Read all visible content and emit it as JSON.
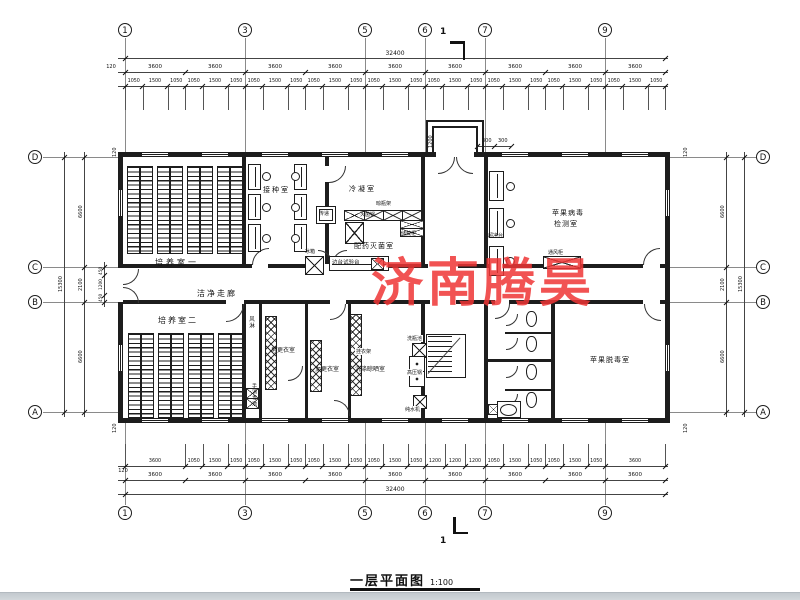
{
  "watermark": {
    "text": "济南腾昊",
    "color": "#ee3535"
  },
  "titleblock": {
    "title": "一层平面图",
    "scale": "1:100"
  },
  "section_marker": {
    "label": "1"
  },
  "axes": {
    "horizontal": [
      {
        "label": "1",
        "mm": 0
      },
      {
        "label": "3",
        "mm": 7200
      },
      {
        "label": "5",
        "mm": 14400
      },
      {
        "label": "6",
        "mm": 18000
      },
      {
        "label": "7",
        "mm": 21600
      },
      {
        "label": "9",
        "mm": 28800
      }
    ],
    "vertical": [
      {
        "label": "D",
        "mm": 0
      },
      {
        "label": "C",
        "mm": 6600
      },
      {
        "label": "B",
        "mm": 8700
      },
      {
        "label": "A",
        "mm": 15300
      }
    ],
    "total_width_mm": 32400,
    "total_height_mm": 15300
  },
  "dims": {
    "top_overall": [
      32400
    ],
    "top_bays": [
      3600,
      3600,
      3600,
      3600,
      3600,
      3600,
      3600,
      3600,
      3600
    ],
    "top_detail": [
      1050,
      1500,
      1050,
      1050,
      1500,
      1050,
      1050,
      1500,
      1050,
      1050,
      1500,
      1050,
      1050,
      1500,
      1050,
      1050,
      1500,
      1050,
      1050,
      1500,
      1050,
      1050,
      1500,
      1050,
      1050,
      1500,
      1050
    ],
    "bottom_detail": [
      3600,
      1050,
      1500,
      1050,
      1050,
      1500,
      1050,
      1050,
      1500,
      1050,
      1050,
      1500,
      1050,
      1200,
      1200,
      1200,
      1050,
      1500,
      1050,
      1050,
      1500,
      1050,
      3600
    ],
    "bottom_bays": [
      3600,
      3600,
      3600,
      3600,
      3600,
      3600,
      3600,
      3600,
      3600
    ],
    "bottom_overall": [
      32400
    ],
    "left_segs": [
      6600,
      2100,
      6600
    ],
    "left_overall": [
      15300
    ],
    "left_subs": [
      450,
      1200,
      450
    ],
    "right_segs": [
      6600,
      2100,
      6600
    ],
    "right_overall": [
      15300
    ],
    "offset_labels": [
      {
        "t": "120",
        "x": 103,
        "y": 64,
        "r": false
      },
      {
        "t": "120",
        "x": 115,
        "y": 468,
        "r": false
      },
      {
        "t": "120",
        "x": 112,
        "y": 158,
        "r": true
      },
      {
        "t": "120",
        "x": 112,
        "y": 434,
        "r": true
      },
      {
        "t": "120",
        "x": 683,
        "y": 158,
        "r": true
      },
      {
        "t": "120",
        "x": 683,
        "y": 434,
        "r": true
      }
    ],
    "porch": {
      "depth": "1200",
      "w1": "300",
      "w2": "300"
    }
  },
  "plan": {
    "walls": [
      [
        118,
        152,
        552,
        5
      ],
      [
        118,
        418,
        552,
        5
      ],
      [
        118,
        152,
        5,
        271
      ],
      [
        665,
        152,
        5,
        271
      ],
      [
        123,
        264,
        542,
        4
      ],
      [
        123,
        300,
        542,
        4
      ],
      [
        242,
        157,
        4,
        107
      ],
      [
        325,
        157,
        4,
        107
      ],
      [
        421,
        157,
        4,
        107
      ],
      [
        484,
        157,
        4,
        107
      ],
      [
        242,
        304,
        4,
        114
      ],
      [
        259,
        304,
        3,
        114
      ],
      [
        305,
        304,
        3,
        114
      ],
      [
        348,
        304,
        3,
        114
      ],
      [
        421,
        304,
        4,
        114
      ],
      [
        484,
        304,
        4,
        114
      ],
      [
        551,
        304,
        4,
        114
      ],
      [
        488,
        359,
        63,
        3
      ],
      [
        505,
        332,
        46,
        2
      ],
      [
        505,
        389,
        46,
        2
      ],
      [
        426,
        120,
        2,
        34
      ],
      [
        426,
        120,
        58,
        2
      ],
      [
        482,
        120,
        2,
        34
      ],
      [
        432,
        126,
        2,
        28
      ],
      [
        432,
        126,
        46,
        2
      ],
      [
        476,
        126,
        2,
        28
      ]
    ],
    "door_gaps": [
      [
        436,
        152,
        38,
        5
      ],
      [
        118,
        268,
        5,
        34
      ],
      [
        318,
        264,
        28,
        4
      ],
      [
        252,
        264,
        16,
        4
      ],
      [
        643,
        264,
        17,
        4
      ],
      [
        428,
        264,
        30,
        4
      ],
      [
        226,
        300,
        18,
        4
      ],
      [
        330,
        300,
        16,
        4
      ],
      [
        430,
        300,
        26,
        4
      ],
      [
        495,
        300,
        14,
        4
      ],
      [
        643,
        300,
        17,
        4
      ],
      [
        325,
        166,
        4,
        16
      ]
    ],
    "door_arcs": [
      [
        438,
        157,
        16,
        "br"
      ],
      [
        456,
        157,
        16,
        "bl"
      ],
      [
        123,
        269,
        15,
        "br"
      ],
      [
        123,
        287,
        15,
        "tr"
      ],
      [
        318,
        250,
        14,
        "tr"
      ],
      [
        332,
        250,
        14,
        "tl"
      ],
      [
        226,
        304,
        17,
        "br"
      ],
      [
        252,
        248,
        16,
        "tl"
      ],
      [
        329,
        166,
        16,
        "br"
      ],
      [
        643,
        248,
        16,
        "tl"
      ],
      [
        644,
        304,
        16,
        "bl"
      ],
      [
        495,
        304,
        14,
        "br"
      ],
      [
        330,
        304,
        15,
        "br"
      ],
      [
        288,
        366,
        14,
        "br"
      ],
      [
        334,
        400,
        15,
        "tr"
      ],
      [
        506,
        314,
        11,
        "br"
      ],
      [
        506,
        338,
        11,
        "br"
      ],
      [
        506,
        366,
        11,
        "br"
      ],
      [
        506,
        394,
        11,
        "br"
      ]
    ],
    "windows_h": [
      [
        142,
        152.8
      ],
      [
        202,
        152.8
      ],
      [
        262,
        152.8
      ],
      [
        322,
        152.8
      ],
      [
        382,
        152.8
      ],
      [
        502,
        152.8
      ],
      [
        562,
        152.8
      ],
      [
        622,
        152.8
      ],
      [
        142,
        418.8
      ],
      [
        202,
        418.8
      ],
      [
        262,
        418.8
      ],
      [
        322,
        418.8
      ],
      [
        382,
        418.8
      ],
      [
        442,
        418.8
      ],
      [
        502,
        418.8
      ],
      [
        562,
        418.8
      ],
      [
        622,
        418.8
      ]
    ],
    "windows_v": [
      [
        118.8,
        190
      ],
      [
        118.8,
        345
      ],
      [
        665.8,
        190
      ],
      [
        665.8,
        345
      ]
    ],
    "racks_r1_x": [
      127,
      140,
      157,
      170,
      187,
      200,
      217,
      230
    ],
    "racks_r2_x": [
      128,
      141,
      158,
      171,
      188,
      201,
      218,
      231
    ],
    "xcols": [
      [
        265,
        316,
        10,
        72
      ],
      [
        310,
        340,
        10,
        50
      ],
      [
        350,
        314,
        10,
        80
      ]
    ],
    "benches": [
      [
        248,
        164,
        11,
        24
      ],
      [
        248,
        194,
        11,
        24
      ],
      [
        248,
        224,
        11,
        26
      ],
      [
        294,
        164,
        11,
        24
      ],
      [
        294,
        194,
        11,
        24
      ],
      [
        294,
        224,
        11,
        26
      ],
      [
        489,
        171,
        13,
        28
      ],
      [
        489,
        208,
        13,
        28
      ],
      [
        489,
        246,
        13,
        28
      ],
      [
        329,
        256,
        58,
        13
      ]
    ],
    "stools": [
      [
        262,
        172
      ],
      [
        262,
        203
      ],
      [
        262,
        234
      ],
      [
        291,
        172
      ],
      [
        291,
        203
      ],
      [
        291,
        234
      ],
      [
        506,
        182
      ],
      [
        506,
        219
      ],
      [
        506,
        257
      ]
    ],
    "xboxes": [
      [
        344,
        210,
        19,
        9
      ],
      [
        364,
        210,
        18,
        9
      ],
      [
        383,
        210,
        18,
        9
      ],
      [
        402,
        210,
        18,
        9
      ],
      [
        345,
        222,
        17,
        20
      ],
      [
        400,
        220,
        22,
        7
      ],
      [
        400,
        228,
        22,
        7
      ],
      [
        305,
        256,
        17,
        17
      ],
      [
        371,
        258,
        11,
        10
      ],
      [
        543,
        256,
        36,
        11
      ],
      [
        412,
        343,
        13,
        13
      ],
      [
        413,
        395,
        12,
        12
      ],
      [
        246,
        388,
        11,
        9
      ],
      [
        246,
        398,
        11,
        9
      ],
      [
        488,
        404,
        9,
        9
      ]
    ],
    "dotboxes": [
      [
        409,
        356,
        14,
        14
      ],
      [
        409,
        371,
        14,
        14
      ]
    ],
    "boxes": [
      [
        316,
        206,
        18,
        16
      ],
      [
        319,
        209,
        12,
        10
      ],
      [
        497,
        401,
        22,
        15
      ]
    ],
    "ovals": [
      [
        500,
        404,
        15,
        10
      ]
    ],
    "fixtures": [
      [
        526,
        311,
        9,
        14
      ],
      [
        526,
        336,
        9,
        14
      ],
      [
        526,
        364,
        9,
        14
      ],
      [
        526,
        392,
        9,
        14
      ]
    ],
    "stair": {
      "frame": [
        426,
        334,
        38,
        42
      ],
      "treads": [
        428,
        336,
        24,
        38
      ],
      "vline": [
        452,
        336,
        1,
        38
      ],
      "diag": [
        428,
        373,
        48,
        -48
      ]
    },
    "labels": [
      {
        "t": "培养室一",
        "x": 155,
        "y": 257,
        "s": 8,
        "ls": 3
      },
      {
        "t": "接种室",
        "x": 263,
        "y": 185,
        "s": 7,
        "ls": 2
      },
      {
        "t": "冷凝室",
        "x": 349,
        "y": 184,
        "s": 7,
        "ls": 2
      },
      {
        "t": "配药灭菌室",
        "x": 354,
        "y": 241,
        "s": 7,
        "ls": 1
      },
      {
        "t": "苹果病毒",
        "x": 552,
        "y": 208,
        "s": 7,
        "ls": 1
      },
      {
        "t": "检测室",
        "x": 554,
        "y": 219,
        "s": 7,
        "ls": 1
      },
      {
        "t": "洁净走廊",
        "x": 197,
        "y": 288,
        "s": 8,
        "ls": 2
      },
      {
        "t": "培养室二",
        "x": 158,
        "y": 315,
        "s": 8,
        "ls": 2
      },
      {
        "t": "男更衣室",
        "x": 271,
        "y": 345,
        "s": 6,
        "ls": 0
      },
      {
        "t": "女更衣室",
        "x": 315,
        "y": 364,
        "s": 6,
        "ls": 0
      },
      {
        "t": "洗涤晾晒室",
        "x": 355,
        "y": 364,
        "s": 6,
        "ls": 0
      },
      {
        "t": "苹果脱毒室",
        "x": 590,
        "y": 355,
        "s": 7,
        "ls": 1
      },
      {
        "t": "灭菌锅",
        "x": 360,
        "y": 211,
        "s": 5,
        "ls": 0
      },
      {
        "t": "晾瓶架",
        "x": 376,
        "y": 200,
        "s": 5,
        "ls": 0
      },
      {
        "t": "储藏柜",
        "x": 401,
        "y": 230,
        "s": 5,
        "ls": 0
      },
      {
        "t": "传递",
        "x": 319,
        "y": 210,
        "s": 5,
        "ls": 0
      },
      {
        "t": "冰箱",
        "x": 305,
        "y": 248,
        "s": 5,
        "ls": 0
      },
      {
        "t": "边台试验台",
        "x": 332,
        "y": 258,
        "s": 5.5,
        "ls": 0
      },
      {
        "t": "超净台",
        "x": 488,
        "y": 232,
        "s": 5,
        "ls": 0
      },
      {
        "t": "通风柜",
        "x": 548,
        "y": 249,
        "s": 5,
        "ls": 0
      },
      {
        "t": "洗瓶池",
        "x": 406,
        "y": 335,
        "s": 5,
        "ls": 0,
        "bg": true
      },
      {
        "t": "高压锅",
        "x": 406,
        "y": 369,
        "s": 5,
        "ls": 0,
        "bg": true
      },
      {
        "t": "纯水机",
        "x": 404,
        "y": 406,
        "s": 5,
        "ls": 0,
        "bg": true
      },
      {
        "t": "挂衣架",
        "x": 355,
        "y": 348,
        "s": 5,
        "ls": 0,
        "bg": true
      },
      {
        "t": "300",
        "x": 482,
        "y": 138,
        "s": 5,
        "ls": 0
      },
      {
        "t": "300",
        "x": 498,
        "y": 138,
        "s": 5,
        "ls": 0
      }
    ],
    "vlabels": [
      {
        "t": "风淋",
        "x": 247,
        "y": 316,
        "s": 5.5
      },
      {
        "t": "手消毒池",
        "x": 251,
        "y": 383,
        "s": 5
      }
    ],
    "rlabels": [
      {
        "t": "1200",
        "x": 428,
        "y": 150,
        "s": 5
      }
    ]
  }
}
